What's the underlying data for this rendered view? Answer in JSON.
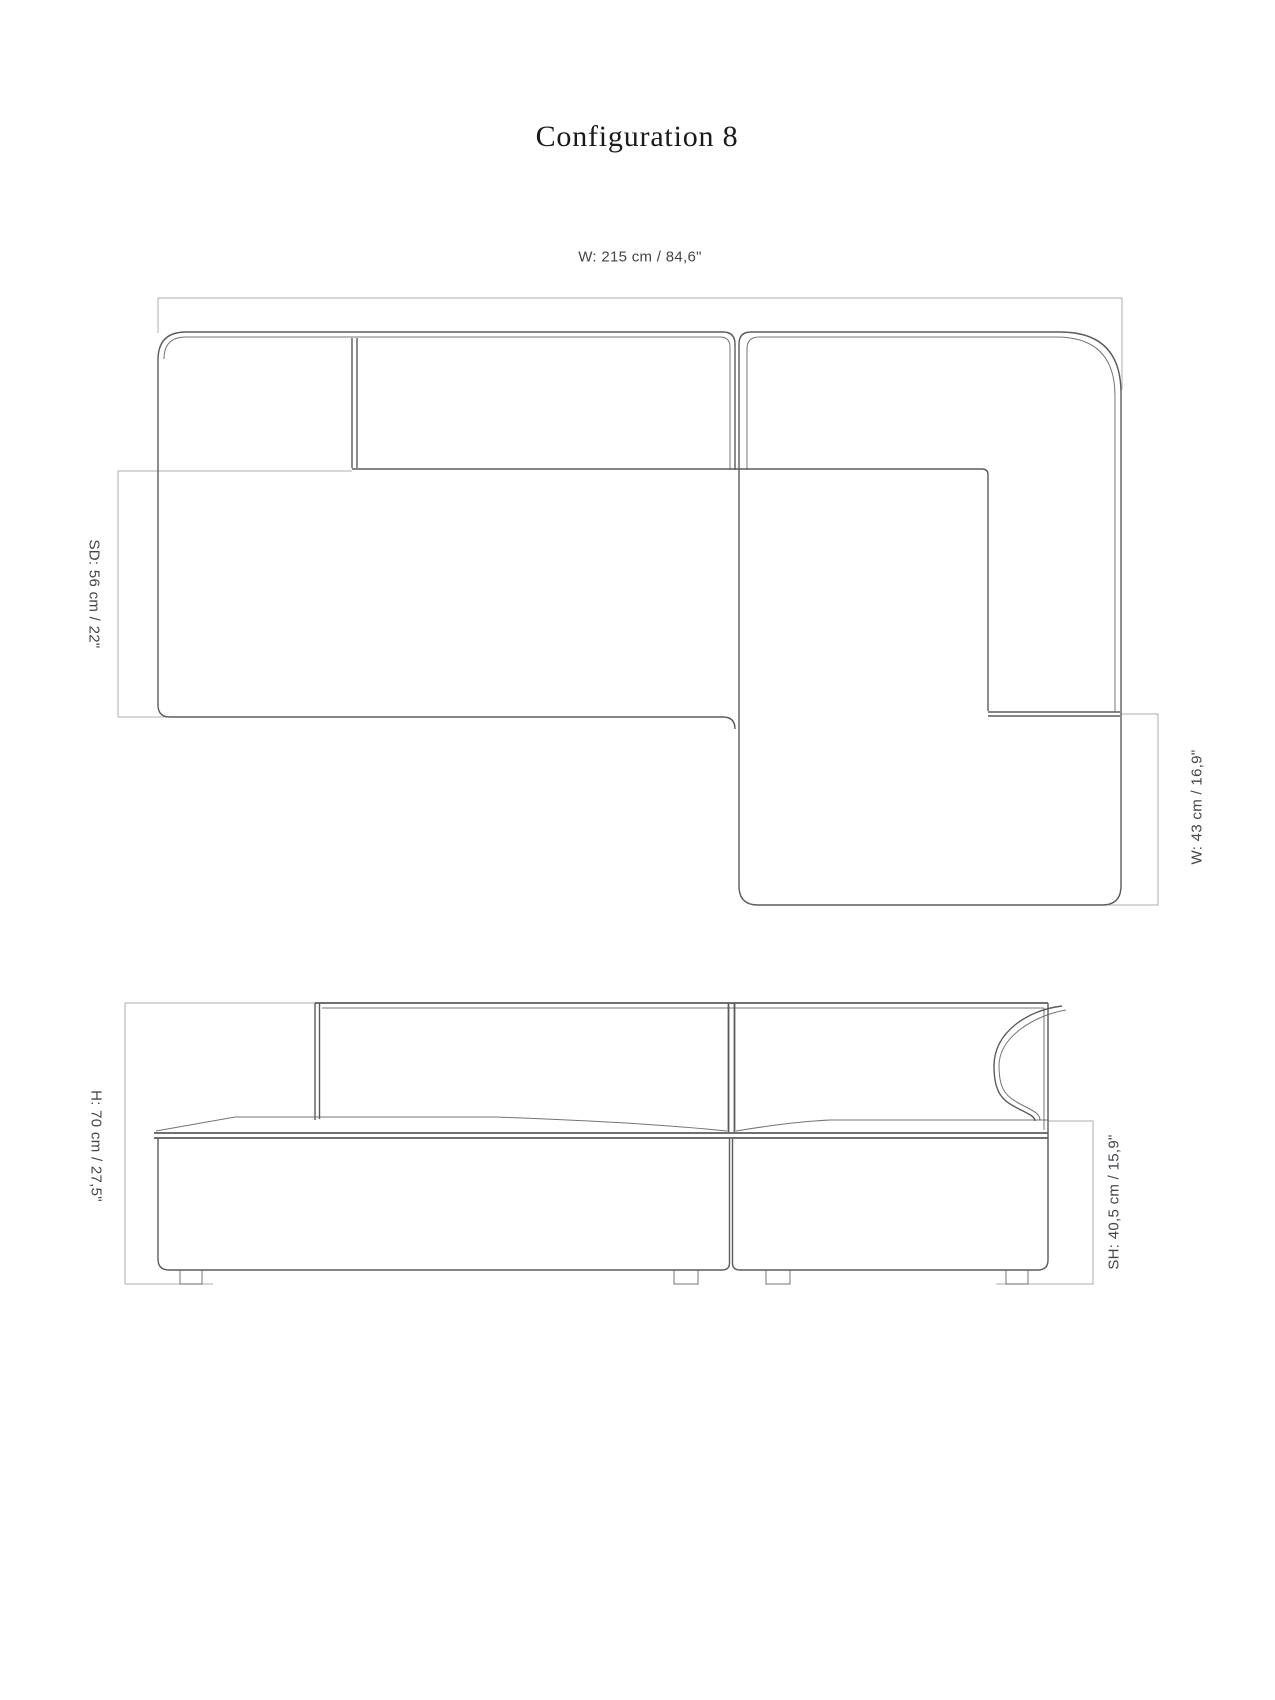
{
  "title": "Configuration 8",
  "views": {
    "top_view": {
      "name": "top view",
      "dimensions": {
        "overall_width": "W: 215 cm / 84,6\"",
        "seat_depth": "SD: 56 cm / 22\"",
        "module_width": "W: 43 cm / 16,9\""
      }
    },
    "front_view": {
      "name": "front view",
      "dimensions": {
        "overall_height": "H: 70 cm / 27,5\"",
        "seat_height": "SH: 40,5 cm / 15,9\""
      }
    }
  },
  "colors": {
    "background": "#ffffff",
    "sofa_line": "#595c5f",
    "dimension_line": "#a9aeb2",
    "label_text": "#40464b",
    "title_text": "#1a1a1a"
  }
}
